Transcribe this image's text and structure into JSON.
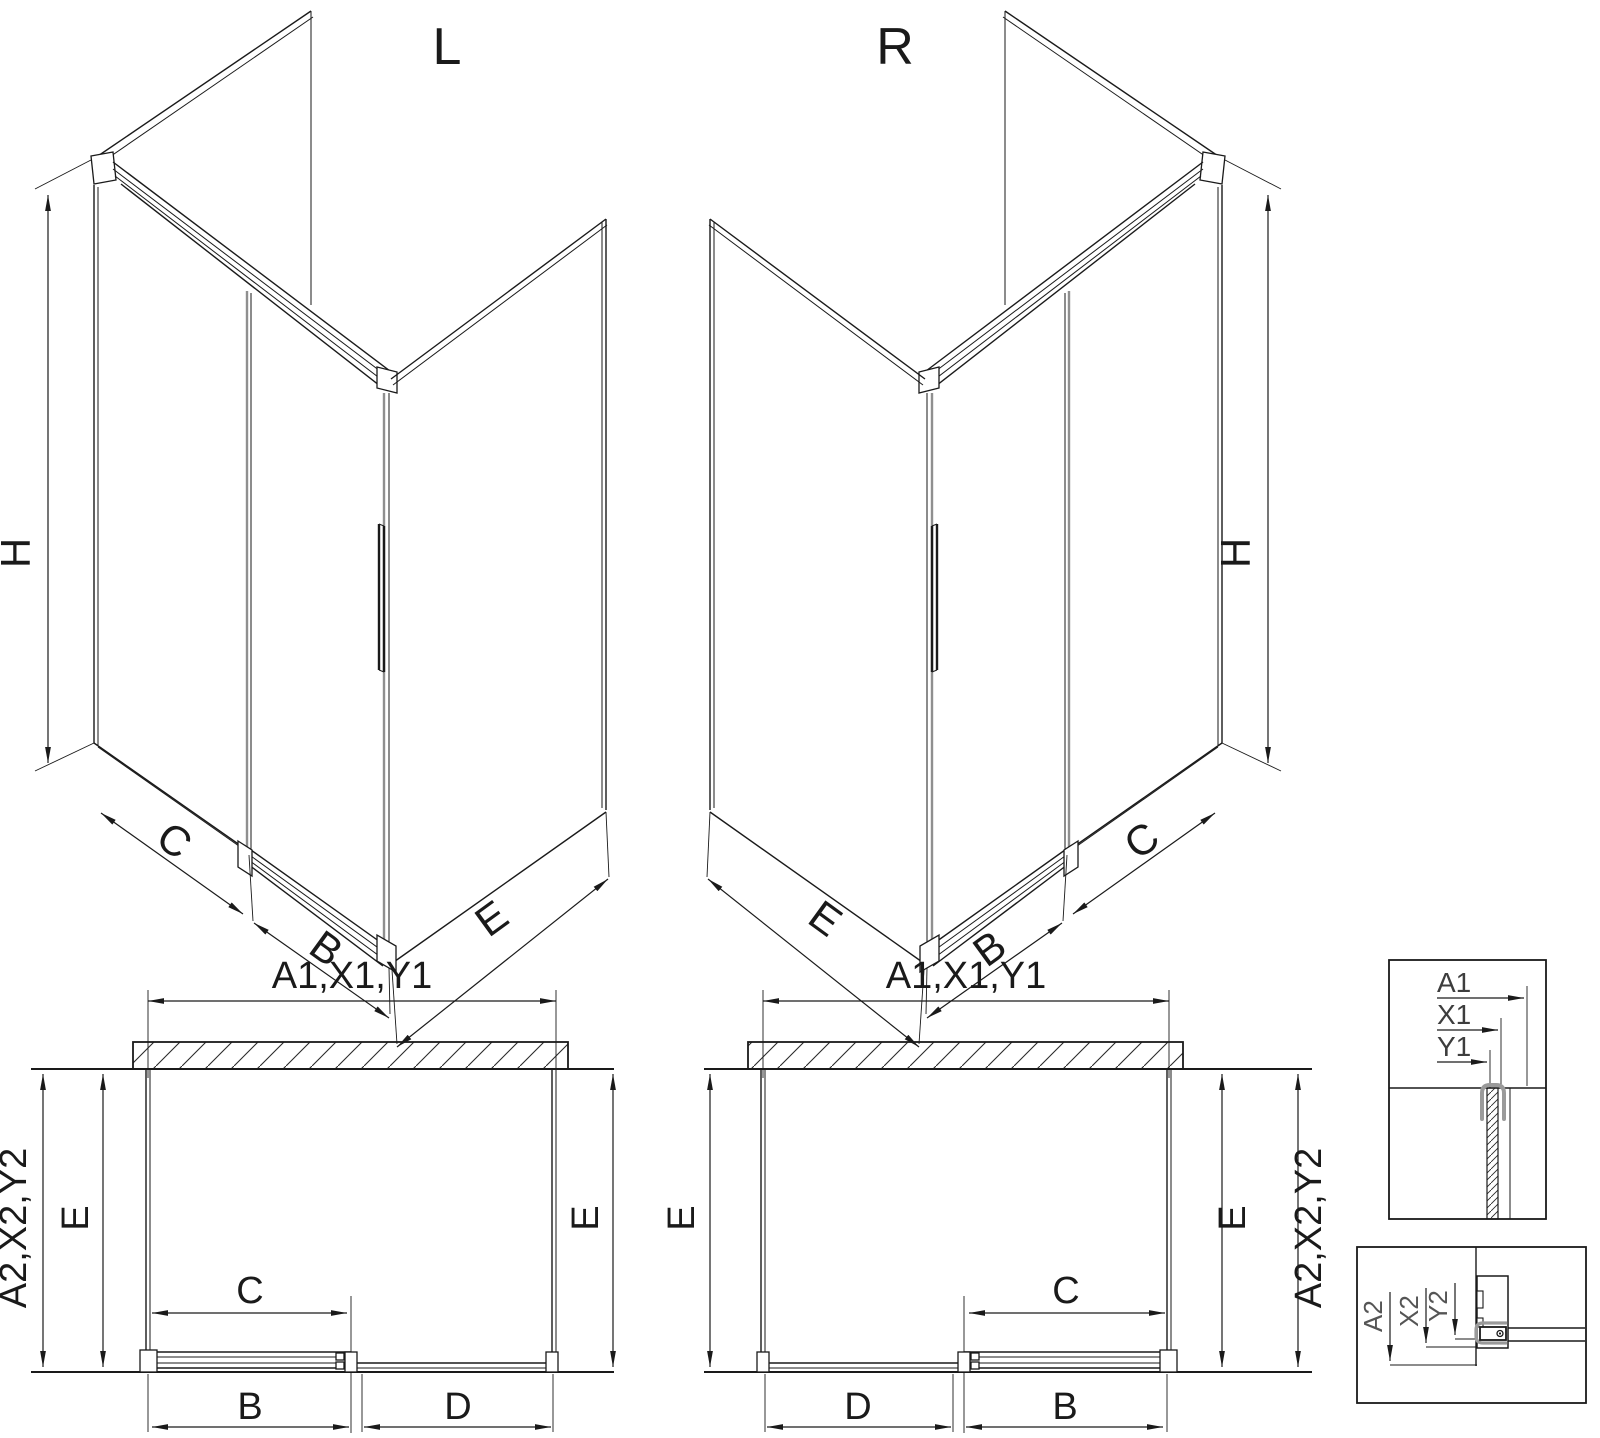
{
  "drawing": {
    "iso_left": {
      "title": "L",
      "height_label": "H",
      "side_label": "C",
      "door_label": "B",
      "return_label": "E"
    },
    "iso_right": {
      "title": "R",
      "height_label": "H",
      "side_label": "C",
      "door_label": "B",
      "return_label": "E"
    },
    "plan_left": {
      "top_label": "A1,X1,Y1",
      "side_label": "A2,X2,Y2",
      "depth_left_label": "E",
      "depth_right_label": "E",
      "door_label": "C",
      "front_left_label": "B",
      "front_right_label": "D"
    },
    "plan_right": {
      "top_label": "A1,X1,Y1",
      "side_label": "A2,X2,Y2",
      "depth_left_label": "E",
      "depth_right_label": "E",
      "door_label": "C",
      "front_left_label": "D",
      "front_right_label": "B"
    },
    "detail_wall_profile": {
      "labels": [
        "A1",
        "X1",
        "Y1"
      ]
    },
    "detail_floor_profile": {
      "labels": [
        "A2",
        "X2",
        "Y2"
      ]
    },
    "colors": {
      "line": "#1a1a1a",
      "gray_profile": "#8f8f8f",
      "clamp": "#9a9a9a",
      "detail_text": "#4a4a4a"
    }
  }
}
